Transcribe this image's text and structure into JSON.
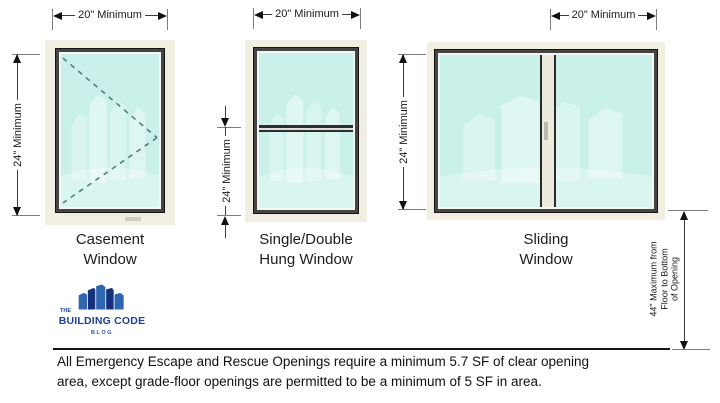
{
  "windows": {
    "casement": {
      "name_line1": "Casement",
      "name_line2": "Window",
      "width_dim": "20\" Minimum",
      "height_dim": "24\" Minimum"
    },
    "hung": {
      "name_line1": "Single/Double",
      "name_line2": "Hung Window",
      "width_dim": "20\" Minimum",
      "height_dim": "24\" Minimum"
    },
    "sliding": {
      "name_line1": "Sliding",
      "name_line2": "Window",
      "width_dim": "20\" Minimum",
      "height_dim": "24\" Minimum"
    }
  },
  "sill_height_dim": {
    "line1": "44\" Maximum from",
    "line2": "Floor to Bottom",
    "line3": "of Opening"
  },
  "logo": {
    "the": "THE",
    "name": "BUILDING CODE",
    "sub": "BLOG"
  },
  "note": {
    "line1": "All Emergency Escape and Rescue Openings require a minimum 5.7 SF of clear opening",
    "line2": "area, except grade-floor openings are permitted to be a minimum of 5 SF in area."
  },
  "colors": {
    "glass": "#c9f1ea",
    "frame_cream": "#f1efe2",
    "frame_dark": "#454545",
    "dimension_line": "#3c3c3c",
    "logo_navy": "#16307c",
    "logo_blue": "#2e66b0",
    "logo_text": "#1d4094"
  }
}
